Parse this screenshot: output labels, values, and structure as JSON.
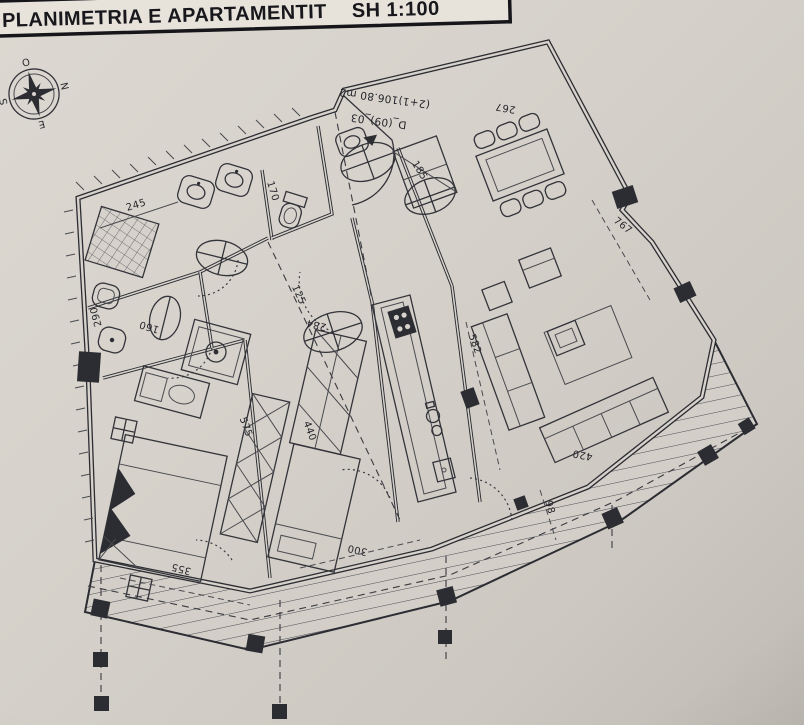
{
  "title": {
    "main": "PLANIMETRIA E APARTAMENTIT",
    "scale": "SH 1:100"
  },
  "apartment": {
    "unit_code": "D_(09)_03",
    "type_area": "(2+1)106.80 m2"
  },
  "compass": {
    "top": "O",
    "right": "N",
    "bottom": "E",
    "left": "S"
  },
  "dimensions": {
    "d245": "245",
    "d170": "170",
    "d125": "125",
    "d284": "284",
    "d290": "290",
    "d160": "160",
    "d575": "575",
    "d440": "440",
    "d185": "185",
    "d267": "267",
    "d767": "767",
    "d582": "582",
    "d420": "420",
    "d98": "98",
    "d300": "300",
    "d355": "355"
  },
  "colors": {
    "paper": "#d6d2cb",
    "ink": "#2c2c33",
    "band": "#e7e3db"
  }
}
